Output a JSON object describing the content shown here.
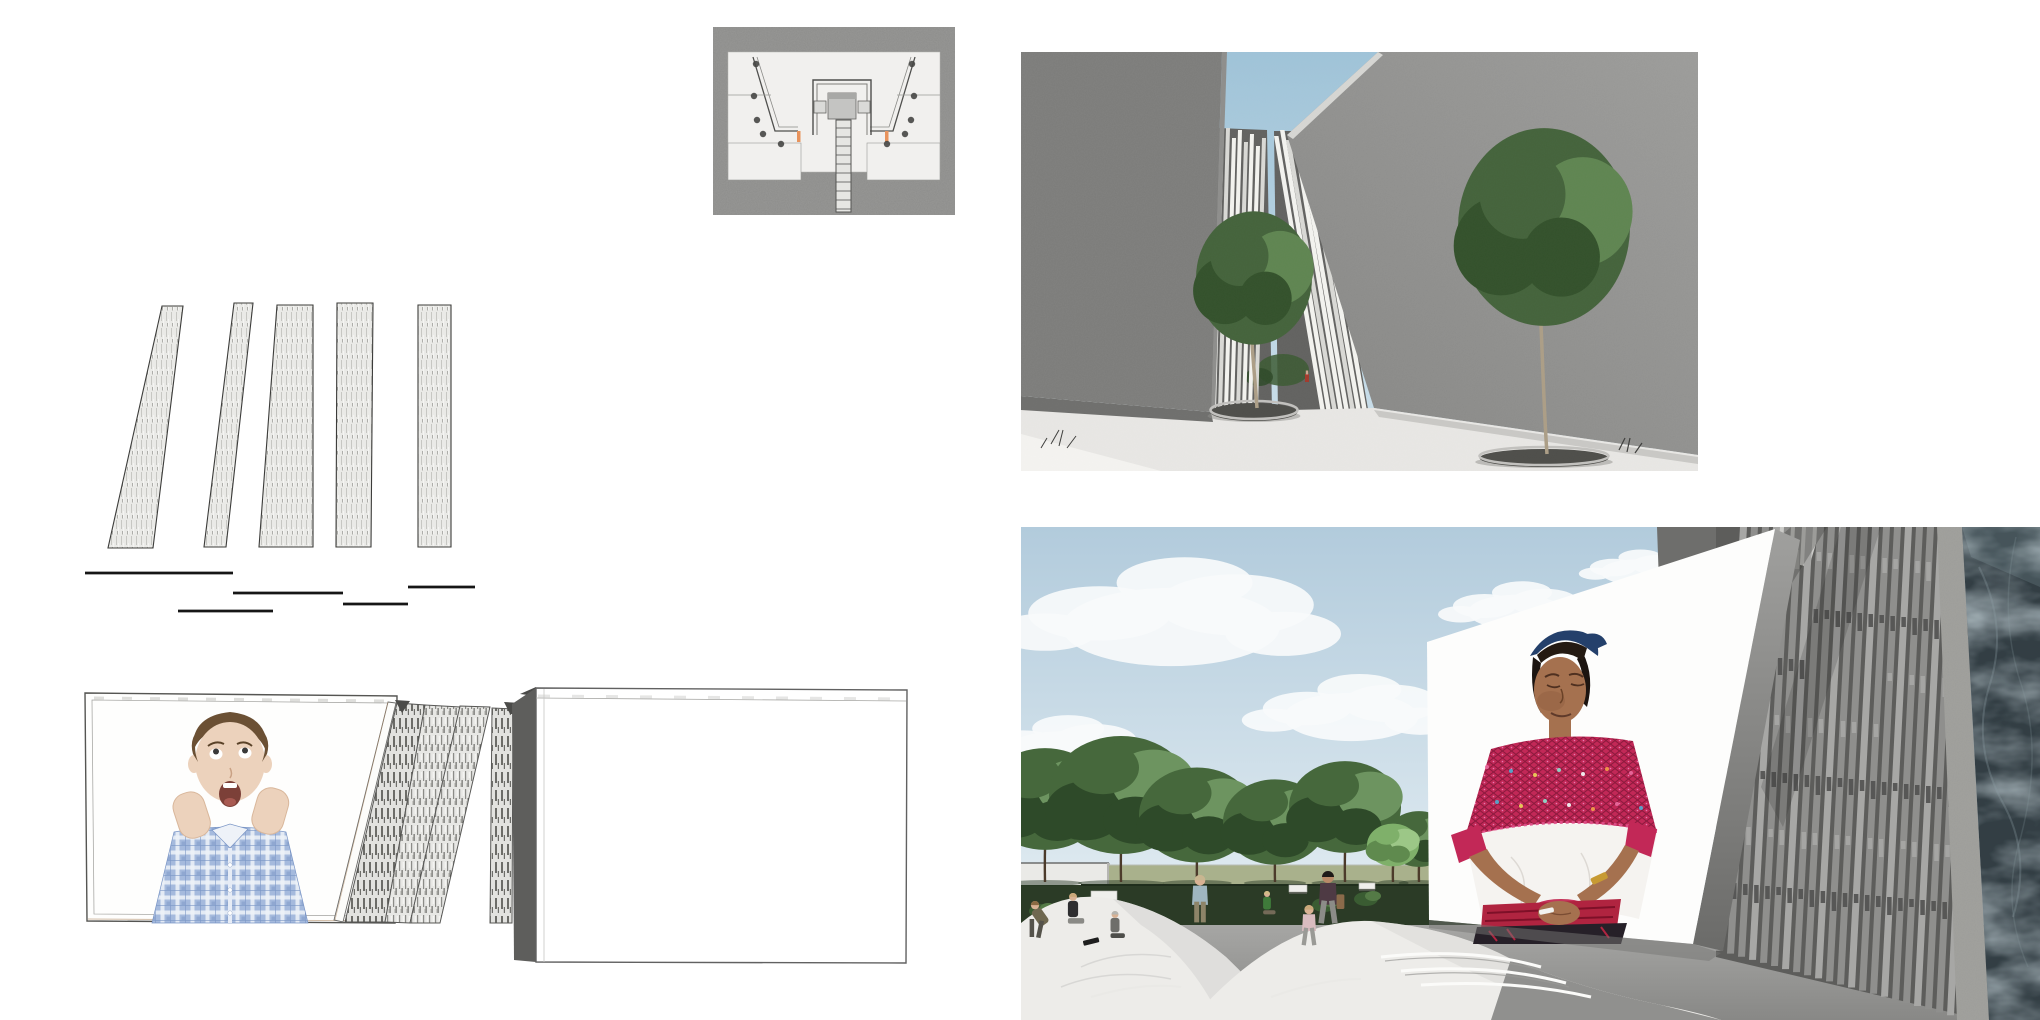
{
  "canvas": {
    "width": 2040,
    "height": 1020,
    "background": "#ffffff"
  },
  "colors": {
    "page_bg": "#ffffff",
    "line": "#161616",
    "outline": "#3c3c3a",
    "hatch_base": "#eaeae7",
    "hatch_dash": "#c7c7c3",
    "hatch_dash2": "#9f9f9b",
    "plan_border": "#8c8c8a",
    "plan_floor": "#f1f0ee",
    "plan_wall": "#4f4f4d",
    "plan_block": "#c4c4c2",
    "plan_block_top": "#a8a8a6",
    "plan_square": "#dadad8",
    "plan_accent": "#e8935c",
    "plan_dot": "#464644",
    "plan_stair": "#e6e6e3",
    "sky_top": "#9fc3d8",
    "sky_bot": "#cfe2ec",
    "wall_left": "#7b7b79",
    "slat_bg": "#626260",
    "slat_white": "#f3f3ef",
    "slat_dim": "#d9d9d5",
    "court_floor": "#e8e7e4",
    "court_floor_sh": "#c9c8c5",
    "court_shadow": "#6f6f6d",
    "court_corner": "#f4f3f0",
    "planter_rim": "#c2c1be",
    "soil": "#4e4e4a",
    "trunk_c": "#ac9e86",
    "ctree_dark": "#33512b",
    "ctree_mid": "#44633b",
    "ctree_light": "#5f8551",
    "fig_red": "#a23a2c",
    "screen_stroke": "#555552",
    "frame_line": "#a9a9a6",
    "warm_line": "#b08a64",
    "wedge_dark": "#4b4b49",
    "box_side": "#5e5e5c",
    "boy_skin": "#ecd2bc",
    "boy_hair": "#6b5034",
    "plaid_base": "#a5badd",
    "plaid_dark": "#7b96c6",
    "plaid_light": "#eef2f8",
    "mouth": "#7c4038",
    "psky_top": "#b2cbdc",
    "psky_bot": "#e0ebf1",
    "cloud": "#f7fafb",
    "lawn": "#a9b18c",
    "ground_dark": "#2b3b26",
    "parapet": "#eaeae7",
    "plaza_floor_a": "#a6a6a4",
    "plaza_floor_b": "#888886",
    "mound": "#edece9",
    "mound_sh": "#d9d8d5",
    "terrace": "#fbfbf9",
    "mound_shadow": "#90908e",
    "wall_block": "#6e6e6c",
    "screen_white": "#fdfdfc",
    "perf_bg": "#5d5d5b",
    "perf_strip": "#8f8f8d",
    "perf_light": "#a7a7a5",
    "perf_slot": "#515150",
    "concrete_band": "#9d9d99",
    "marble": "#333e44",
    "marble_vein": "#8ea0a5",
    "w_skin": "#a5714f",
    "w_skin_sh": "#8d5c3f",
    "w_hair": "#1c1410",
    "headband": "#24406b",
    "magenta": "#c22857",
    "magenta_dark": "#8d1a3e",
    "blouse_white": "#f5f3f0",
    "belt_red": "#b02440",
    "skirt": "#262028",
    "gold": "#c79a33",
    "ptree_dark": "#2e4a29",
    "ptree_mid": "#46683c",
    "ptree_light": "#6d9460",
    "trunk_p": "#4c3b2b"
  },
  "site_plan": {
    "x": 713,
    "y": 27,
    "w": 242,
    "h": 188,
    "dots_left": [
      [
        43,
        37
      ],
      [
        41,
        69
      ],
      [
        44,
        93
      ],
      [
        50,
        107
      ],
      [
        68,
        117
      ]
    ],
    "dots_right": [
      [
        199,
        37
      ],
      [
        201,
        69
      ],
      [
        198,
        93
      ],
      [
        192,
        107
      ],
      [
        174,
        117
      ]
    ],
    "stair_rungs": 10
  },
  "panel_diagram": {
    "x": 85,
    "y": 295,
    "w": 400,
    "h": 330,
    "panels": [
      [
        77,
        11,
        98,
        11,
        68,
        253,
        23,
        253
      ],
      [
        149,
        8,
        168,
        8,
        141,
        252,
        119,
        252
      ],
      [
        192,
        10,
        228,
        10,
        228,
        252,
        174,
        252
      ],
      [
        252,
        8,
        288,
        8,
        286,
        252,
        251,
        252
      ],
      [
        333,
        10,
        366,
        10,
        366,
        252,
        333,
        252
      ]
    ],
    "lines": [
      [
        0,
        278,
        148
      ],
      [
        148,
        298,
        258
      ],
      [
        93,
        316,
        188
      ],
      [
        258,
        309,
        323
      ],
      [
        323,
        292,
        390
      ]
    ]
  },
  "courtyard": {
    "x": 1021,
    "y": 52,
    "w": 677,
    "h": 419,
    "slats_left": [
      [
        199,
        80
      ],
      [
        205,
        76
      ],
      [
        211,
        86
      ],
      [
        217,
        78
      ],
      [
        223,
        90
      ],
      [
        229,
        82
      ],
      [
        235,
        94
      ],
      [
        241,
        86
      ]
    ],
    "slats_right": [
      [
        253,
        84
      ],
      [
        259,
        78
      ],
      [
        265,
        88
      ],
      [
        271,
        80
      ],
      [
        277,
        92
      ],
      [
        283,
        84
      ],
      [
        289,
        96
      ],
      [
        295,
        88
      ]
    ],
    "trees": [
      {
        "x": 233,
        "y": 226,
        "r": 58,
        "base": 356,
        "trunk_top": 258
      },
      {
        "x": 523,
        "y": 175,
        "r": 86,
        "base": 402,
        "trunk_top": 250
      }
    ]
  },
  "screen_elevation": {
    "x": 80,
    "y": 680,
    "w": 830,
    "h": 290
  },
  "plaza": {
    "x": 1021,
    "y": 527,
    "w": 1019,
    "h": 493,
    "clouds": [
      {
        "x": 150,
        "y": 100,
        "s": 1.7
      },
      {
        "x": 330,
        "y": 190,
        "s": 1.05
      },
      {
        "x": 495,
        "y": 85,
        "s": 0.75
      },
      {
        "x": 40,
        "y": 225,
        "s": 0.9
      },
      {
        "x": 615,
        "y": 45,
        "s": 0.55
      }
    ],
    "trees": [
      {
        "x": 24,
        "y": 272,
        "r": 62
      },
      {
        "x": 100,
        "y": 268,
        "r": 72
      },
      {
        "x": 176,
        "y": 288,
        "r": 58
      },
      {
        "x": 254,
        "y": 295,
        "r": 52
      },
      {
        "x": 324,
        "y": 280,
        "r": 56
      },
      {
        "x": 398,
        "y": 312,
        "r": 34
      },
      {
        "x": 372,
        "y": 318,
        "r": 26,
        "light": true
      },
      {
        "x": 440,
        "y": 328,
        "r": 22
      }
    ],
    "benches": [
      [
        70,
        364,
        26,
        9
      ],
      [
        268,
        358,
        18,
        7
      ],
      [
        338,
        356,
        16,
        6
      ]
    ],
    "shrubs": [
      [
        20,
        384
      ],
      [
        303,
        378
      ],
      [
        345,
        372
      ],
      [
        424,
        384
      ]
    ],
    "people": [
      {
        "x": 14,
        "y": 410,
        "h": 36,
        "pose": "bend",
        "hair": "#8a6a42",
        "top": "#6f6850",
        "bottom": "#55534b",
        "skin": "#d9b294"
      },
      {
        "x": 52,
        "y": 400,
        "h": 34,
        "pose": "sit",
        "hair": "#caa87a",
        "top": "#2e2e30",
        "bottom": "#8a8a86",
        "skin": "#d9b294"
      },
      {
        "x": 94,
        "y": 414,
        "h": 30,
        "pose": "sit",
        "hair": "#b5b5b0",
        "top": "#6e6e6a",
        "bottom": "#4e4e4a",
        "skin": "#d9b294"
      },
      {
        "x": 179,
        "y": 394,
        "h": 46,
        "pose": "stand",
        "hair": "#c8b690",
        "top": "#9fb6c0",
        "bottom": "#8d8468",
        "skin": "#d9b294"
      },
      {
        "x": 246,
        "y": 390,
        "h": 26,
        "pose": "sit",
        "hair": "#d2bc86",
        "top": "#3f7a3a",
        "bottom": "#746a58",
        "skin": "#d9b294"
      },
      {
        "x": 307,
        "y": 396,
        "h": 52,
        "pose": "walk",
        "hair": "#1e1a18",
        "top": "#4e3a44",
        "bottom": "#8c8c88",
        "skin": "#b98a68",
        "bag": "#8a6a4a"
      },
      {
        "x": 288,
        "y": 418,
        "h": 40,
        "pose": "walk",
        "hair": "#caa87a",
        "top": "#d9bcc0",
        "bottom": "#9a9a96",
        "skin": "#d9b294"
      }
    ],
    "perf": {
      "x0": 695,
      "x1": 930,
      "step": 11,
      "w": 7,
      "lean": 24
    },
    "yoke_dot_colors": [
      "#e8689c",
      "#53a8cc",
      "#eace58",
      "#8fd8c8",
      "#f2f2f2",
      "#f09a4a"
    ]
  }
}
